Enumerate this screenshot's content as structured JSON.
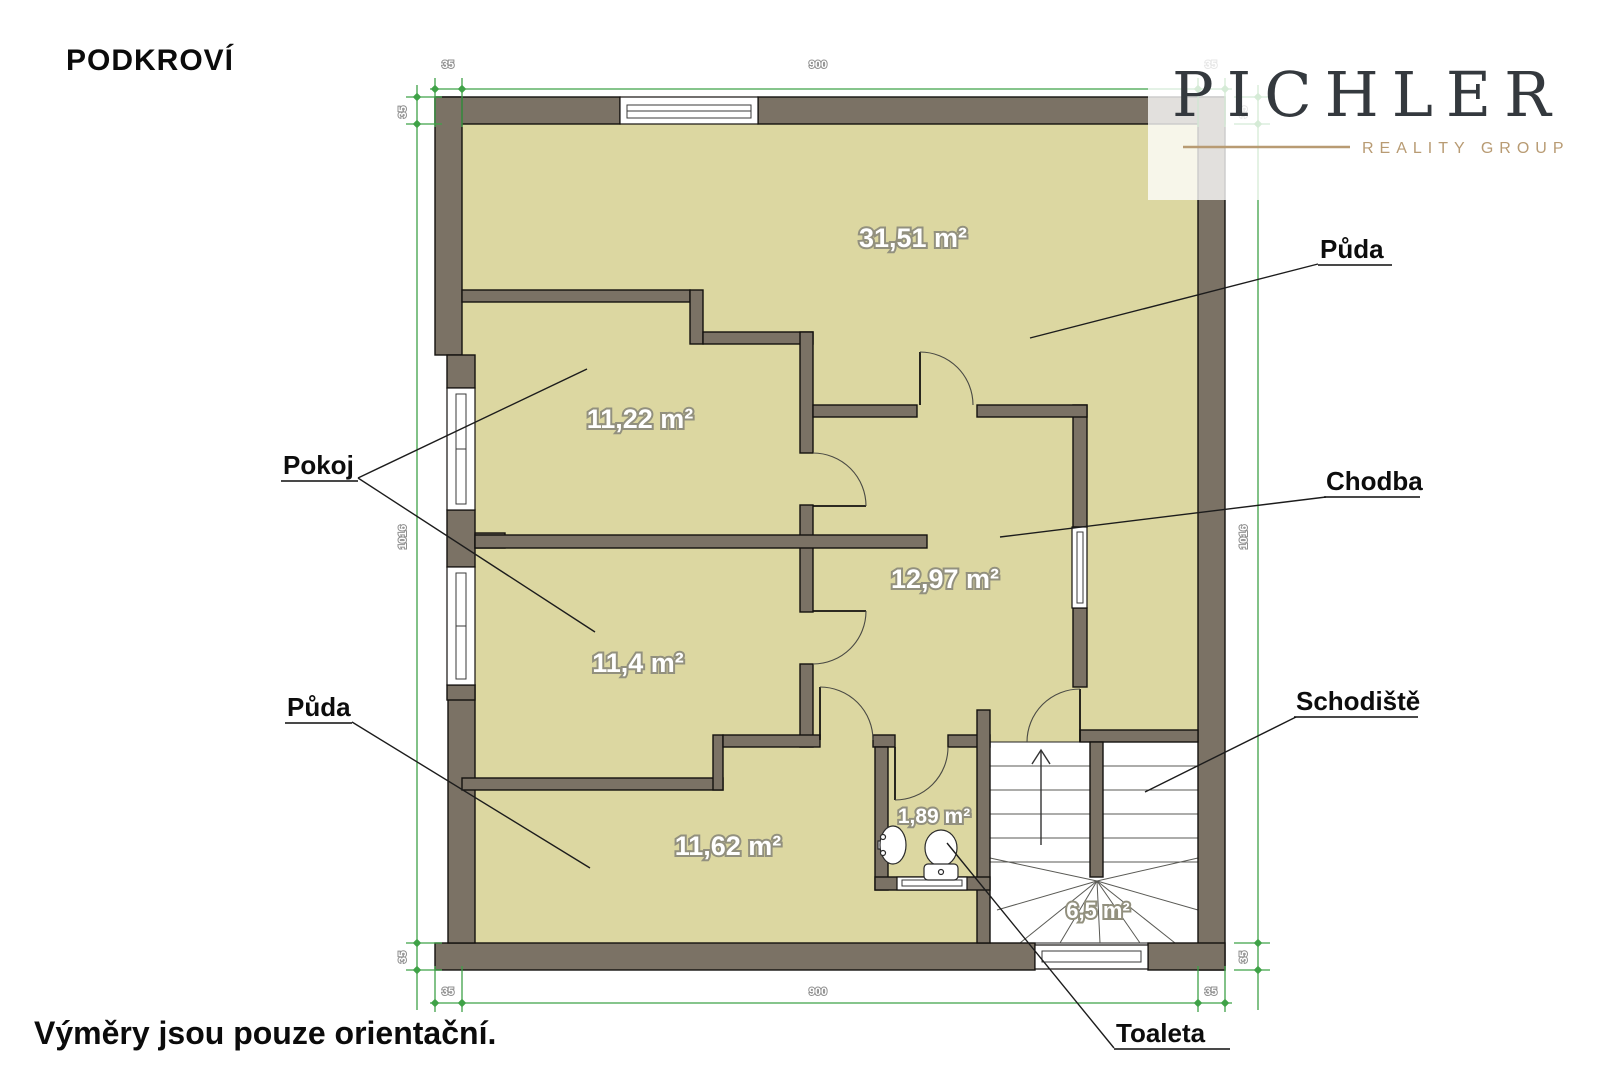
{
  "title": "PODKROVÍ",
  "footnote": "Výměry jsou pouze orientační.",
  "logo": {
    "name": "PICHLER",
    "tagline": "REALITY GROUP"
  },
  "rooms": {
    "attic_top": "31,51 m²",
    "bedroom1": "11,22 m²",
    "hallway": "12,97 m²",
    "bedroom2": "11,4 m²",
    "attic_bottom": "11,62 m²",
    "toilet": "1,89 m²",
    "staircase": "6,5 m²"
  },
  "callouts": {
    "puda_top": "Půda",
    "pokoj": "Pokoj",
    "chodba": "Chodba",
    "puda_bottom": "Půda",
    "schodiste": "Schodiště",
    "toaleta": "Toaleta"
  },
  "dimensions": {
    "top": [
      "35",
      "900",
      "35"
    ],
    "bottom": [
      "35",
      "900",
      "35"
    ],
    "left": [
      "35",
      "1016",
      "35"
    ],
    "right": [
      "35",
      "1016",
      "35"
    ]
  },
  "colors": {
    "floor": "#dcd7a1",
    "wall": "#7b7265",
    "dimension_green": "#3fa247",
    "logo_dark": "#34393e",
    "logo_tan": "#b89b73"
  }
}
